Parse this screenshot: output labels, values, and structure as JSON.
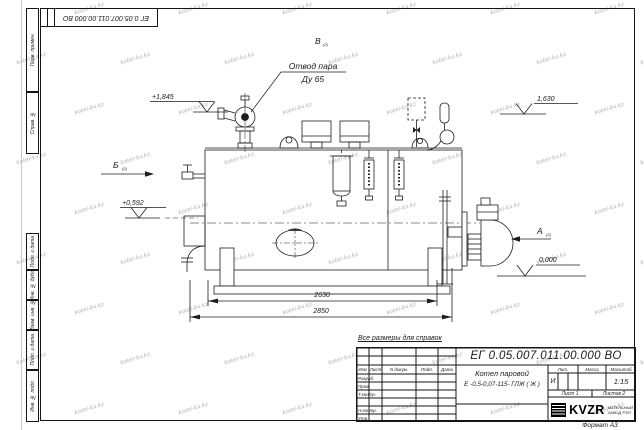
{
  "watermark": {
    "text": "kotel-kv.kz"
  },
  "corner_stamp": {
    "doc_number_rotated": "ЕГ 0.05.007.011.00.000  ВО"
  },
  "side_columns": [
    "Перв. примен.",
    "Справ. №",
    "Подп. и дата",
    "Инв. № дубл.",
    "Взам. инв. №",
    "Подп. и дата",
    "Инв. № подл."
  ],
  "drawing": {
    "callout": {
      "line1": "Отвод пара",
      "line2": "Ду 65"
    },
    "views": {
      "a": "А",
      "b": "Б",
      "v": "В",
      "sub": "(2)"
    },
    "levels": {
      "l1": "+1,845",
      "l2": "+0,592",
      "l3": "1,630",
      "l4": "0,000"
    },
    "dimensions": {
      "d1": "2630",
      "d2": "2850"
    },
    "note": "Все размеры для справок"
  },
  "title_block": {
    "doc_number": "ЕГ 0.05.007.011.00.000  ВО",
    "product_name_line1": "Котел паровой",
    "product_name_line2": "Е -0,5-0,07-115- ГЛЖ ( Ж )",
    "cols": {
      "izm": "Изм",
      "list": "Лист",
      "doc": "N докум.",
      "sign": "Подп.",
      "date": "Дата"
    },
    "rows": {
      "r1": "Разраб.",
      "r2": "Пров.",
      "r3": "Т.контр.",
      "r4": "Н.контр.",
      "r5": "Утв."
    },
    "lit": {
      "label": "Лит.",
      "value": "И"
    },
    "mass": {
      "label": "Масса",
      "value": ""
    },
    "scale": {
      "label": "Масштаб",
      "value": "1:15"
    },
    "sheet": "Лист 1",
    "sheets": "Листов 2",
    "company": {
      "logo": "KVZR",
      "line1": "КОТЕЛЬНЫЙ",
      "line2": "ЗАВОД РЭП"
    },
    "format": "Формат А3"
  }
}
